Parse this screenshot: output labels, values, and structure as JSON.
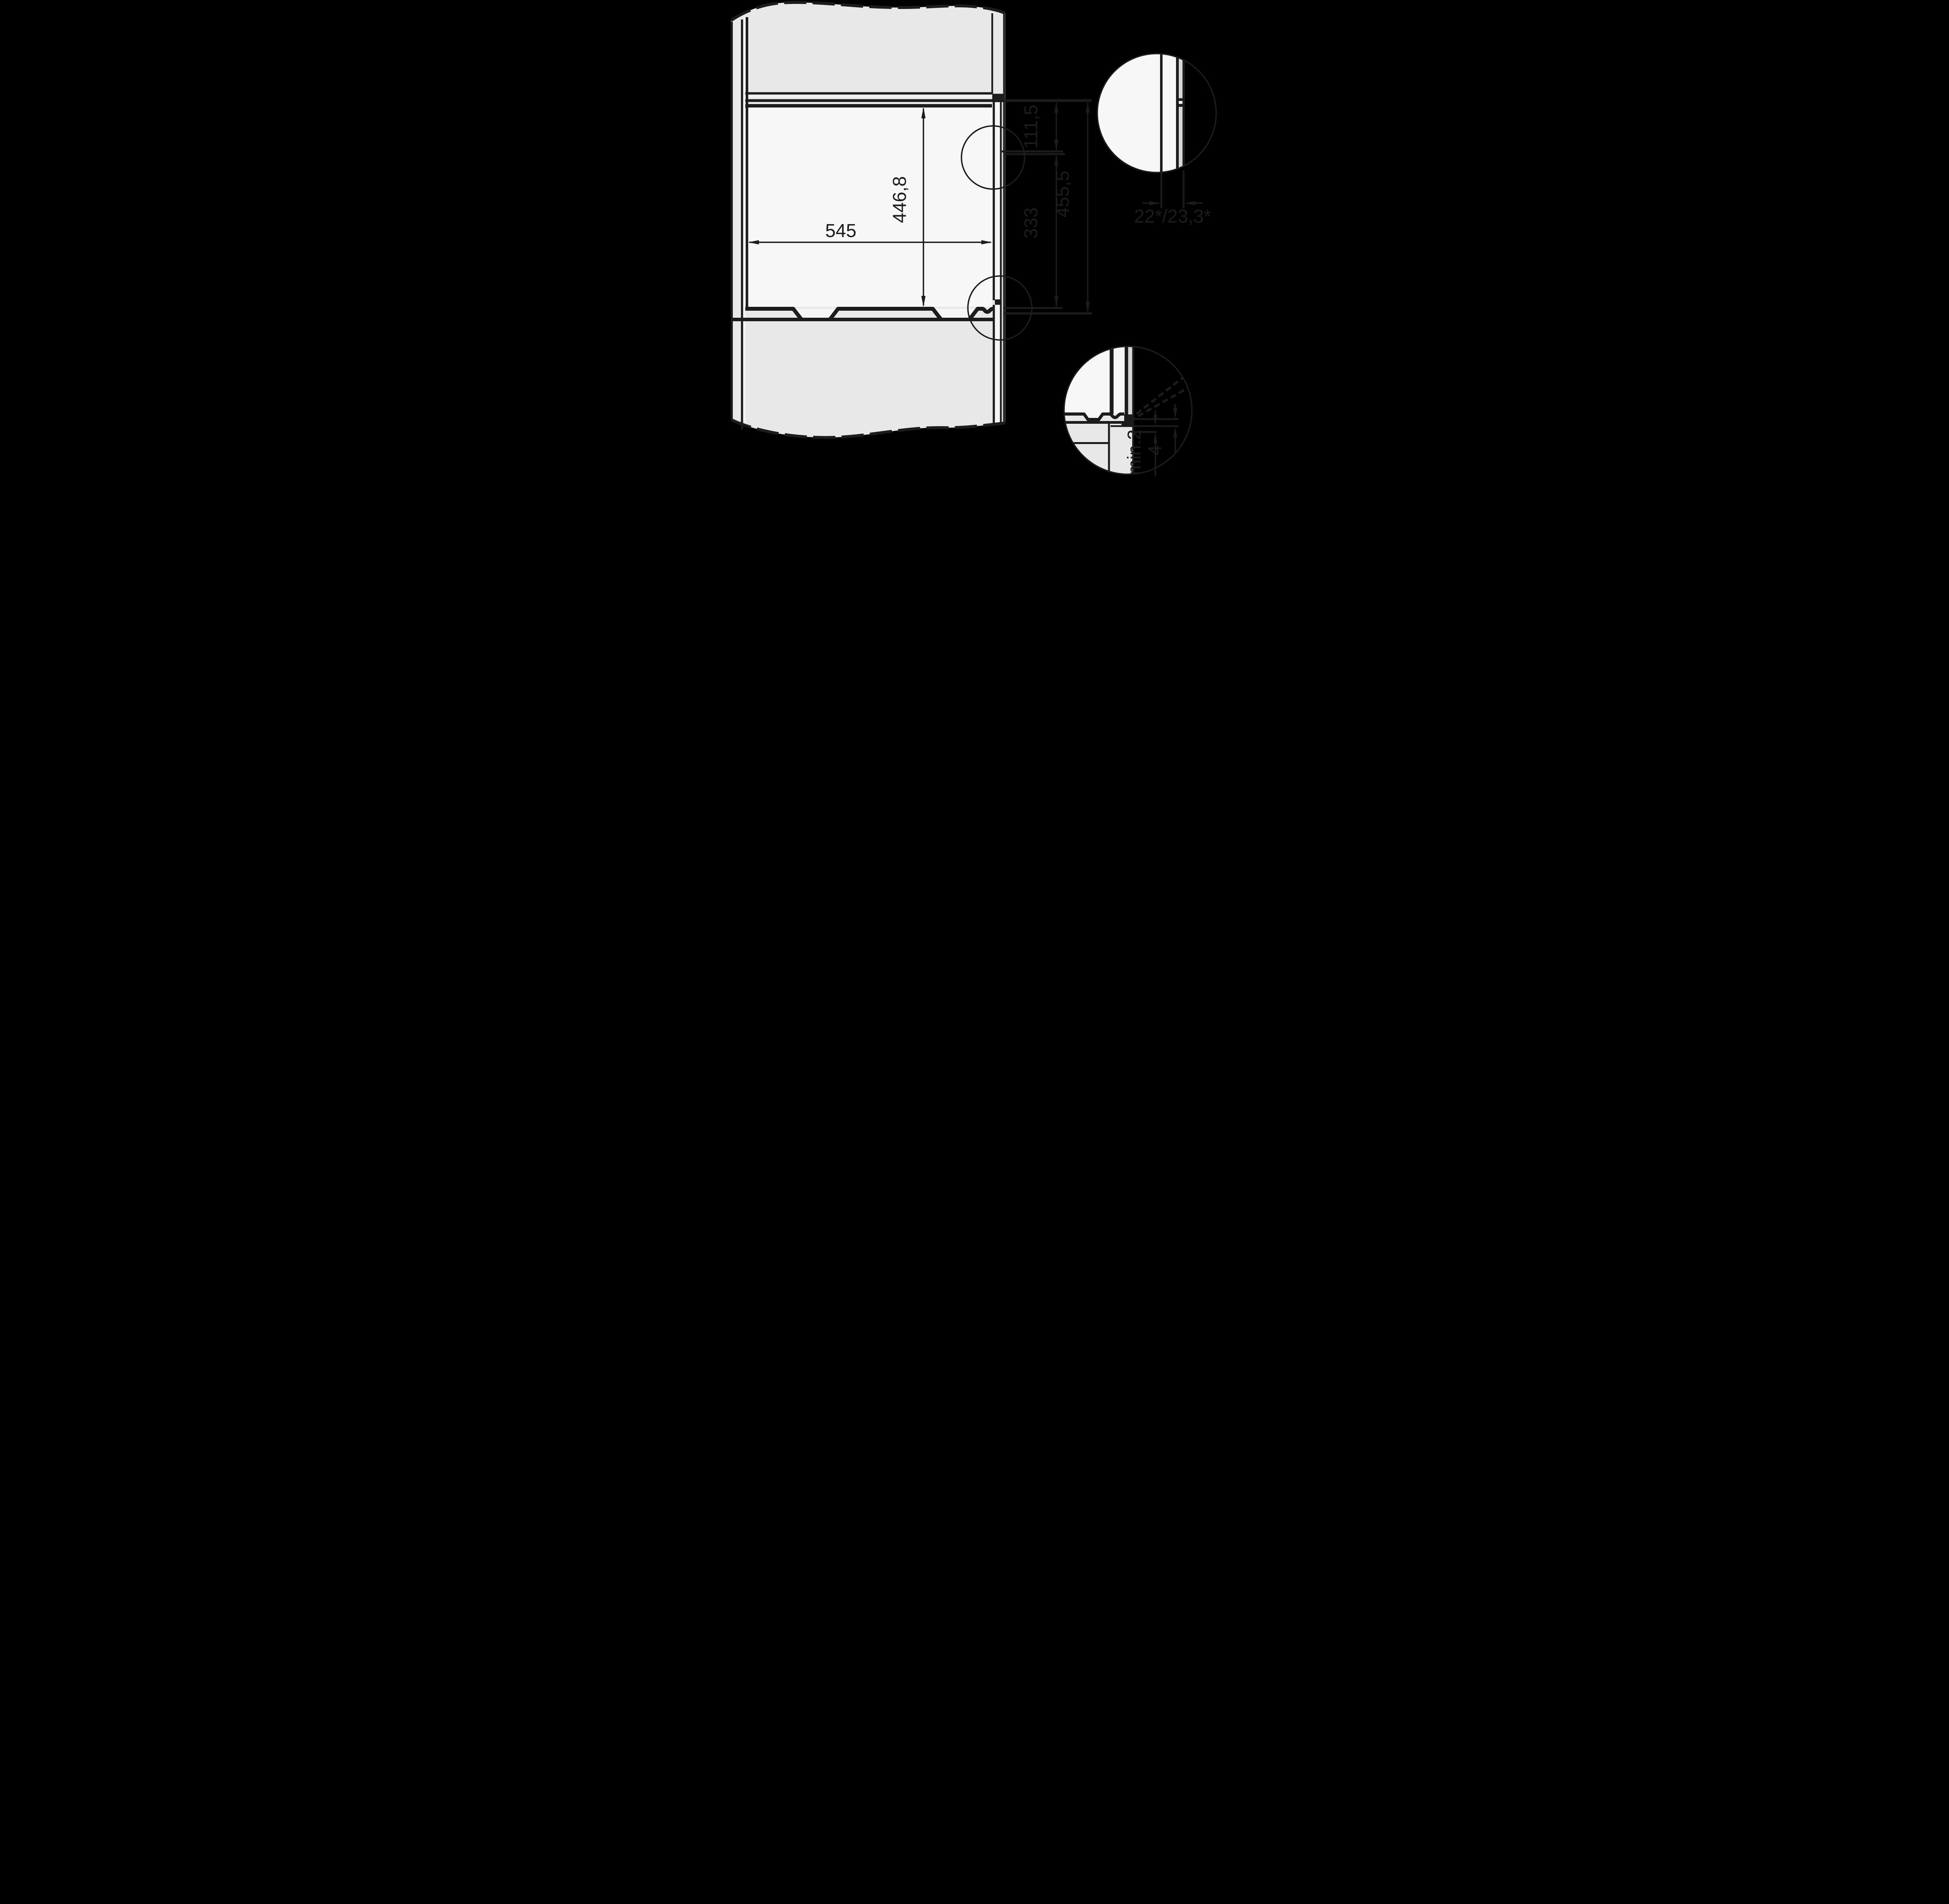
{
  "diagram": {
    "type": "appliance-installation-cross-section",
    "colors": {
      "background": "#000000",
      "line": "#1c1c1c",
      "cabinet_fill": "#e8e8e8",
      "niche_fill": "#f7f7f7",
      "wall_gap_fill": "#f5f5f5",
      "front_panel_fill": "#d8d8d8"
    },
    "dimensions": {
      "niche_height": {
        "label": "446,8"
      },
      "niche_width": {
        "label": "545"
      },
      "offset_top": {
        "label": "111,5"
      },
      "offset_middle": {
        "label": "333"
      },
      "offset_total": {
        "label": "455,5"
      },
      "front_panel_thickness": {
        "label": "22*/23,3*"
      },
      "rear_clearance": {
        "label": "min.2"
      },
      "bottom_gap": {
        "label": "4"
      }
    }
  }
}
